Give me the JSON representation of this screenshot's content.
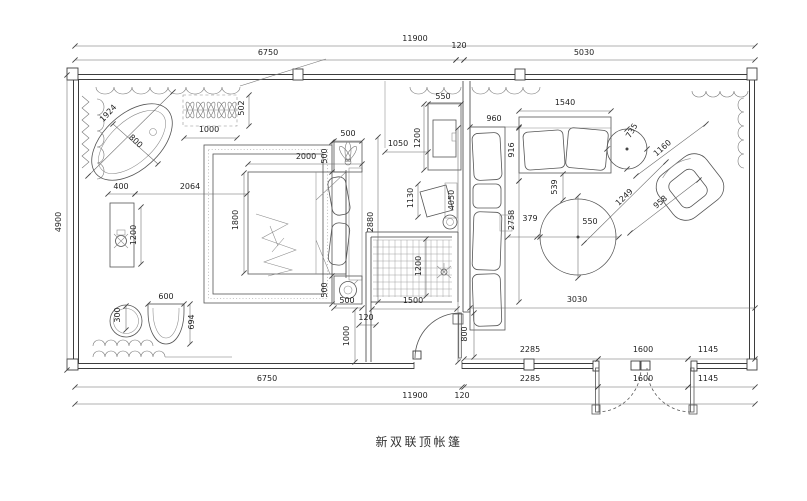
{
  "title": {
    "text": "新双联顶帐篷"
  },
  "drawing": {
    "overall_width_mm": "11900",
    "overall_depth_mm": "4900",
    "line_color": "#3d3d3d",
    "background": "#ffffff"
  },
  "dimensions": [
    {
      "text": "11900",
      "x": 415,
      "y": 41,
      "rot": 0,
      "line": [
        75,
        46,
        755,
        46
      ]
    },
    {
      "text": "6750",
      "x": 268,
      "y": 55,
      "rot": 0,
      "line": [
        75,
        60,
        456,
        60
      ]
    },
    {
      "text": "120",
      "x": 459,
      "y": 48,
      "rot": 0,
      "line": [
        456,
        60,
        464,
        60
      ]
    },
    {
      "text": "5030",
      "x": 584,
      "y": 55,
      "rot": 0,
      "line": [
        464,
        60,
        755,
        60
      ]
    },
    {
      "text": "4900",
      "x": 61,
      "y": 222,
      "rot": -90,
      "line": [
        67,
        75,
        67,
        370
      ]
    },
    {
      "text": "6750",
      "x": 267,
      "y": 381,
      "rot": 0,
      "line": [
        75,
        387,
        462,
        387
      ]
    },
    {
      "text": "2285",
      "x": 530,
      "y": 352,
      "rot": 0,
      "line": [
        464,
        359,
        598,
        359
      ]
    },
    {
      "text": "1600",
      "x": 643,
      "y": 352,
      "rot": 0,
      "line": [
        598,
        359,
        688,
        359
      ]
    },
    {
      "text": "1145",
      "x": 708,
      "y": 352,
      "rot": 0,
      "line": [
        688,
        359,
        755,
        359
      ]
    },
    {
      "text": "2285",
      "x": 530,
      "y": 381,
      "rot": 0,
      "line": [
        464,
        387,
        598,
        387
      ]
    },
    {
      "text": "1600",
      "x": 643,
      "y": 381,
      "rot": 0,
      "line": [
        598,
        387,
        688,
        387
      ]
    },
    {
      "text": "1145",
      "x": 708,
      "y": 381,
      "rot": 0,
      "line": [
        688,
        387,
        755,
        387
      ]
    },
    {
      "text": "11900",
      "x": 415,
      "y": 398,
      "rot": 0,
      "line": [
        75,
        404,
        755,
        404
      ]
    },
    {
      "text": "120",
      "x": 462,
      "y": 398,
      "rot": 0,
      "line": null
    },
    {
      "text": "1924",
      "x": 110,
      "y": 115,
      "rot": -47,
      "line": [
        88,
        176,
        173,
        92
      ]
    },
    {
      "text": "800",
      "x": 134,
      "y": 143,
      "rot": 43,
      "line": [
        113,
        124,
        158,
        164
      ]
    },
    {
      "text": "1000",
      "x": 209,
      "y": 132,
      "rot": 0,
      "line": [
        184,
        138,
        237,
        138
      ]
    },
    {
      "text": "502",
      "x": 244,
      "y": 108,
      "rot": -90,
      "line": [
        249,
        95,
        249,
        126
      ]
    },
    {
      "text": "400",
      "x": 121,
      "y": 189,
      "rot": 0,
      "line": [
        108,
        194,
        135,
        194
      ]
    },
    {
      "text": "2064",
      "x": 190,
      "y": 189,
      "rot": 0,
      "line": [
        135,
        194,
        247,
        194
      ]
    },
    {
      "text": "1200",
      "x": 136,
      "y": 235,
      "rot": -90,
      "line": [
        141,
        207,
        141,
        264
      ]
    },
    {
      "text": "1800",
      "x": 238,
      "y": 220,
      "rot": -90,
      "line": [
        244,
        173,
        244,
        273
      ]
    },
    {
      "text": "300",
      "x": 120,
      "y": 315,
      "rot": -90,
      "line": [
        126,
        306,
        126,
        330
      ]
    },
    {
      "text": "600",
      "x": 166,
      "y": 299,
      "rot": 0,
      "line": [
        148,
        304,
        184,
        304
      ]
    },
    {
      "text": "694",
      "x": 194,
      "y": 322,
      "rot": -90,
      "line": [
        190,
        304,
        190,
        344
      ]
    },
    {
      "text": "2000",
      "x": 306,
      "y": 159,
      "rot": 0,
      "line": [
        248,
        164,
        362,
        164
      ]
    },
    {
      "text": "500",
      "x": 348,
      "y": 136,
      "rot": 0,
      "line": [
        334,
        141,
        362,
        141
      ]
    },
    {
      "text": "500",
      "x": 327,
      "y": 156,
      "rot": -90,
      "line": [
        332,
        142,
        332,
        172
      ]
    },
    {
      "text": "500",
      "x": 327,
      "y": 290,
      "rot": -90,
      "line": [
        332,
        276,
        332,
        304
      ]
    },
    {
      "text": "500",
      "x": 347,
      "y": 303,
      "rot": 0,
      "line": [
        334,
        308,
        362,
        308
      ]
    },
    {
      "text": "2880",
      "x": 373,
      "y": 222,
      "rot": -90,
      "line": [
        378,
        137,
        378,
        302
      ]
    },
    {
      "text": "120",
      "x": 366,
      "y": 320,
      "rot": 0,
      "line": [
        359,
        325,
        376,
        325
      ]
    },
    {
      "text": "1000",
      "x": 349,
      "y": 336,
      "rot": -90,
      "line": [
        355,
        310,
        355,
        362
      ]
    },
    {
      "text": "550",
      "x": 443,
      "y": 99,
      "rot": 0,
      "line": [
        428,
        104,
        461,
        104
      ]
    },
    {
      "text": "1200",
      "x": 420,
      "y": 138,
      "rot": -90,
      "line": [
        424,
        104,
        424,
        170
      ]
    },
    {
      "text": "1050",
      "x": 398,
      "y": 146,
      "rot": 0,
      "line": [
        385,
        152,
        428,
        152
      ]
    },
    {
      "text": "1130",
      "x": 413,
      "y": 198,
      "rot": -90,
      "line": [
        418,
        184,
        418,
        217
      ]
    },
    {
      "text": "1200",
      "x": 421,
      "y": 266,
      "rot": -90,
      "line": [
        426,
        239,
        426,
        296
      ]
    },
    {
      "text": "1500",
      "x": 413,
      "y": 303,
      "rot": 0,
      "line": [
        372,
        309,
        457,
        309
      ]
    },
    {
      "text": "800",
      "x": 467,
      "y": 334,
      "rot": -90,
      "line": [
        474,
        313,
        474,
        357
      ]
    },
    {
      "text": "960",
      "x": 494,
      "y": 121,
      "rot": 0,
      "line": [
        470,
        127,
        519,
        127
      ]
    },
    {
      "text": "1540",
      "x": 565,
      "y": 105,
      "rot": 0,
      "line": [
        519,
        111,
        611,
        111
      ]
    },
    {
      "text": "916",
      "x": 514,
      "y": 150,
      "rot": -90,
      "line": [
        519,
        128,
        519,
        181
      ]
    },
    {
      "text": "2758",
      "x": 514,
      "y": 220,
      "rot": -90,
      "line": [
        519,
        181,
        519,
        302
      ]
    },
    {
      "text": "4050",
      "x": 454,
      "y": 200,
      "rot": -90,
      "line": [
        458,
        128,
        458,
        362
      ]
    },
    {
      "text": "539",
      "x": 557,
      "y": 187,
      "rot": -90,
      "line": [
        563,
        174,
        563,
        200
      ]
    },
    {
      "text": "379",
      "x": 530,
      "y": 221,
      "rot": 0,
      "line": [
        508,
        237,
        540,
        237
      ]
    },
    {
      "text": "550",
      "x": 590,
      "y": 224,
      "rot": 0,
      "line": null
    },
    {
      "text": "3030",
      "x": 577,
      "y": 302,
      "rot": 0,
      "line": [
        470,
        308,
        755,
        308
      ]
    },
    {
      "text": "1249",
      "x": 626,
      "y": 199,
      "rot": -44,
      "line": [
        584,
        243,
        666,
        162
      ]
    },
    {
      "text": "735",
      "x": 634,
      "y": 132,
      "rot": -60,
      "line": null
    },
    {
      "text": "1160",
      "x": 664,
      "y": 150,
      "rot": -41,
      "line": [
        636,
        176,
        706,
        124
      ]
    },
    {
      "text": "958",
      "x": 662,
      "y": 204,
      "rot": -41,
      "line": [
        630,
        233,
        699,
        180
      ]
    }
  ]
}
